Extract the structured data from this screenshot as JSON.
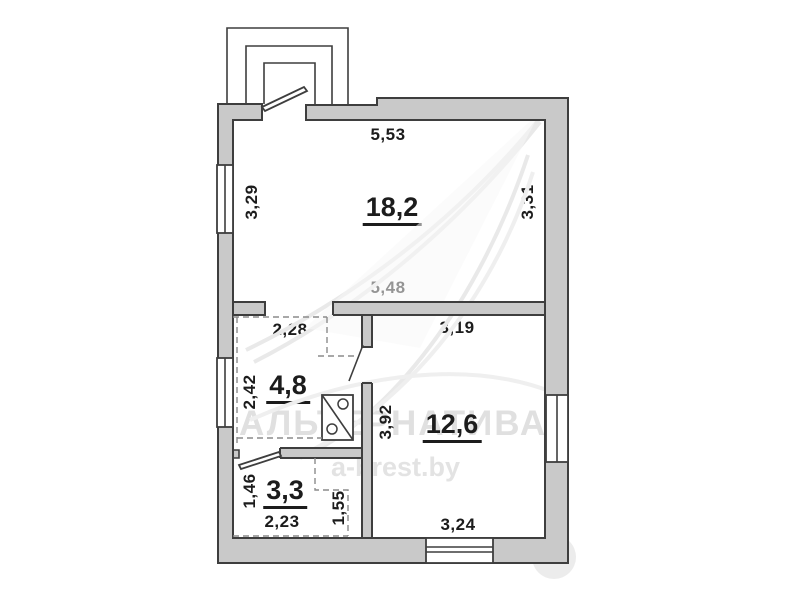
{
  "plan": {
    "rooms": [
      {
        "name": "living-room",
        "area_label": "18,2"
      },
      {
        "name": "hall",
        "area_label": "4,8"
      },
      {
        "name": "room-2",
        "area_label": "12,6"
      },
      {
        "name": "bathroom",
        "area_label": "3,3"
      }
    ],
    "dimensions": {
      "top_width": "5,53",
      "left_height_main": "3,29",
      "right_height_main": "3,31",
      "bottom_width_main": "5,48",
      "hall_top_width": "2,28",
      "room2_top_width": "3,19",
      "hall_left_height": "2,42",
      "room2_left_height": "3,92",
      "bath_left_height": "1,46",
      "bath_bottom_width": "2,23",
      "bath_nook_height": "1,55",
      "room2_bottom_width": "3,24"
    }
  },
  "watermark": {
    "title": "АЛЬТЕРНАТИВА",
    "site": "a-brest.by"
  },
  "colors": {
    "wall_fill": "#c9c9c9",
    "line": "#3e3e3e",
    "label": "#1c1c1c",
    "watermark": "#c2c2c2"
  }
}
